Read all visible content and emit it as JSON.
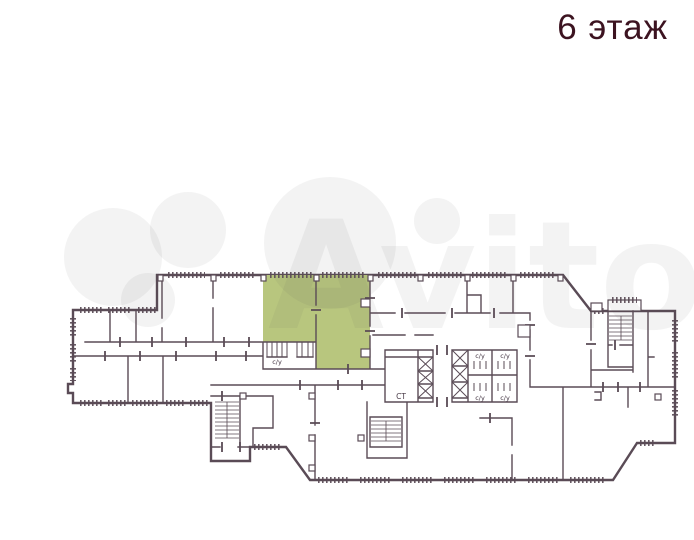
{
  "page": {
    "title": "6 этаж"
  },
  "watermark": {
    "text": "Avito"
  },
  "plan": {
    "labels": {
      "bathroom": "с/у",
      "stairs": "СТ"
    },
    "highlighted_room_count": 2
  },
  "colors": {
    "wall": "#5a4b56",
    "highlight": "#b8c67e",
    "title": "#3c1320",
    "label": "#463845",
    "watermark": "#5a5a5a"
  }
}
